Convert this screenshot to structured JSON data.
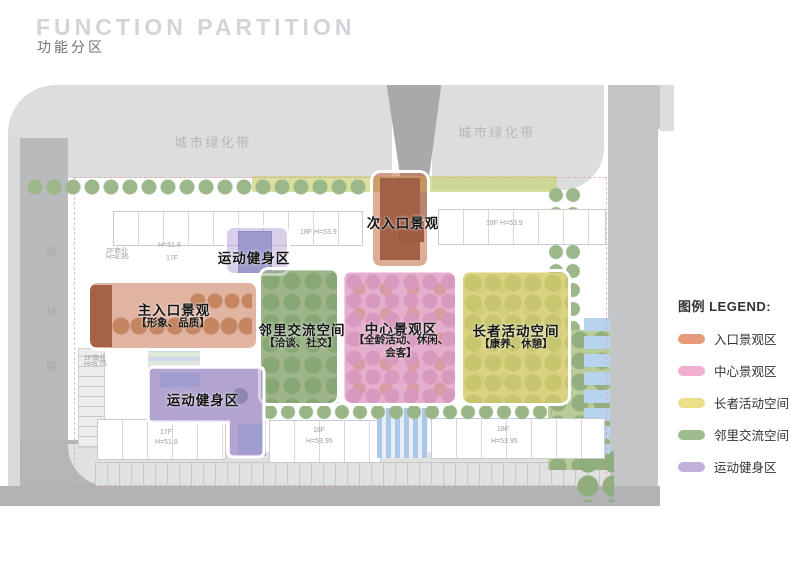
{
  "header": {
    "title_en": "FUNCTION PARTITION",
    "title_zh": "功能分区"
  },
  "map": {
    "green_belt_labels": [
      "城市绿化带",
      "城市绿化带"
    ],
    "road_name": [
      "振",
      "林",
      "路"
    ],
    "zones": [
      {
        "id": "secondary-entrance-landscape",
        "label": "次入口景观",
        "sublabel": "",
        "color": "#e59b7a"
      },
      {
        "id": "sports-fitness-upper",
        "label": "运动健身区",
        "sublabel": "",
        "color": "#c3b1dc"
      },
      {
        "id": "main-entrance-landscape",
        "label": "主入口景观",
        "sublabel": "【形象、品质】",
        "color": "#e59b7a"
      },
      {
        "id": "neighborhood-exchange-space",
        "label": "邻里交流空间",
        "sublabel": "【洽谈、社交】",
        "color": "#9fbb90"
      },
      {
        "id": "central-landscape",
        "label": "中心景观区",
        "sublabel": "【全龄活动、休闲、会客】",
        "color": "#f1aed0"
      },
      {
        "id": "elder-activity-space",
        "label": "长者活动空间",
        "sublabel": "【康养、休憩】",
        "color": "#ecdf8a"
      },
      {
        "id": "sports-fitness-lower",
        "label": "运动健身区",
        "sublabel": "",
        "color": "#c3b1dc"
      }
    ],
    "building_labels": [
      "2F商业",
      "H=8.85",
      "H=51.9",
      "17F",
      "18F H=53.9",
      "18F H=53.9",
      "2F商业",
      "H=8.75",
      "17F",
      "H=51.8",
      "18F",
      "H=53.95",
      "18F",
      "H=53.95"
    ]
  },
  "legend": {
    "title": "图例 LEGEND:",
    "items": [
      {
        "label": "入口景观区",
        "color": "#e59b7a"
      },
      {
        "label": "中心景观区",
        "color": "#f1aed0"
      },
      {
        "label": "长者活动空间",
        "color": "#ecdf8a"
      },
      {
        "label": "邻里交流空间",
        "color": "#9fbb90"
      },
      {
        "label": "运动健身区",
        "color": "#c3b1dc"
      }
    ]
  }
}
